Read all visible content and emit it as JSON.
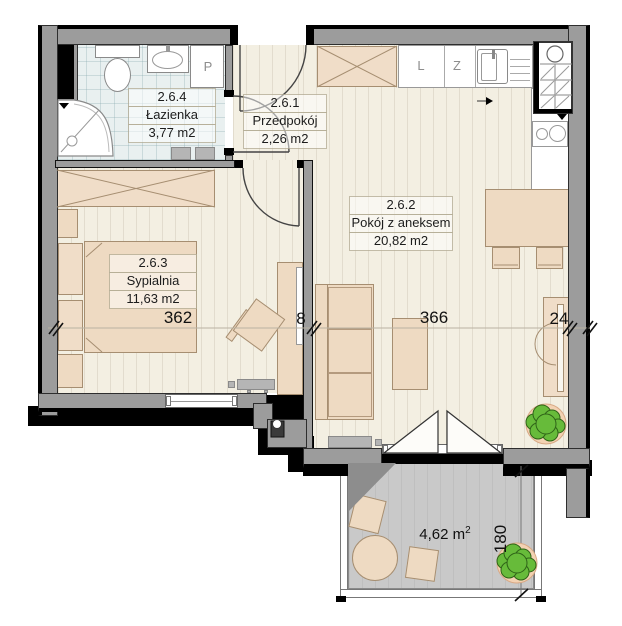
{
  "rooms": {
    "bathroom": {
      "number": "2.6.4",
      "name": "Łazienka",
      "area": "3,77 m2"
    },
    "hallway": {
      "number": "2.6.1",
      "name": "Przedpokój",
      "area": "2,26 m2"
    },
    "living": {
      "number": "2.6.2",
      "name": "Pokój z aneksem",
      "area": "20,82 m2"
    },
    "bedroom": {
      "number": "2.6.3",
      "name": "Sypialnia",
      "area": "11,63 m2"
    }
  },
  "dimensions": {
    "bedroom_width": "362",
    "partition_wall": "8",
    "living_width": "366",
    "right_nook": "24",
    "balcony_depth": "180"
  },
  "balcony": {
    "area_value": "4,62 m",
    "area_superscript": "2"
  },
  "appliance_labels": {
    "fridge": "L",
    "dishwasher": "Z",
    "washing_machine": "P"
  },
  "colors": {
    "wall_gray": "#9c9c9c",
    "outline_black": "#000000",
    "floor_cream": "#f3efe2",
    "bathroom_floor": "#e9f0f0",
    "furniture_beige": "#eedac2",
    "balcony_gray": "#c9c9c9",
    "plant_green": "#67bb3a",
    "plant_pot": "#f3d2b3"
  }
}
